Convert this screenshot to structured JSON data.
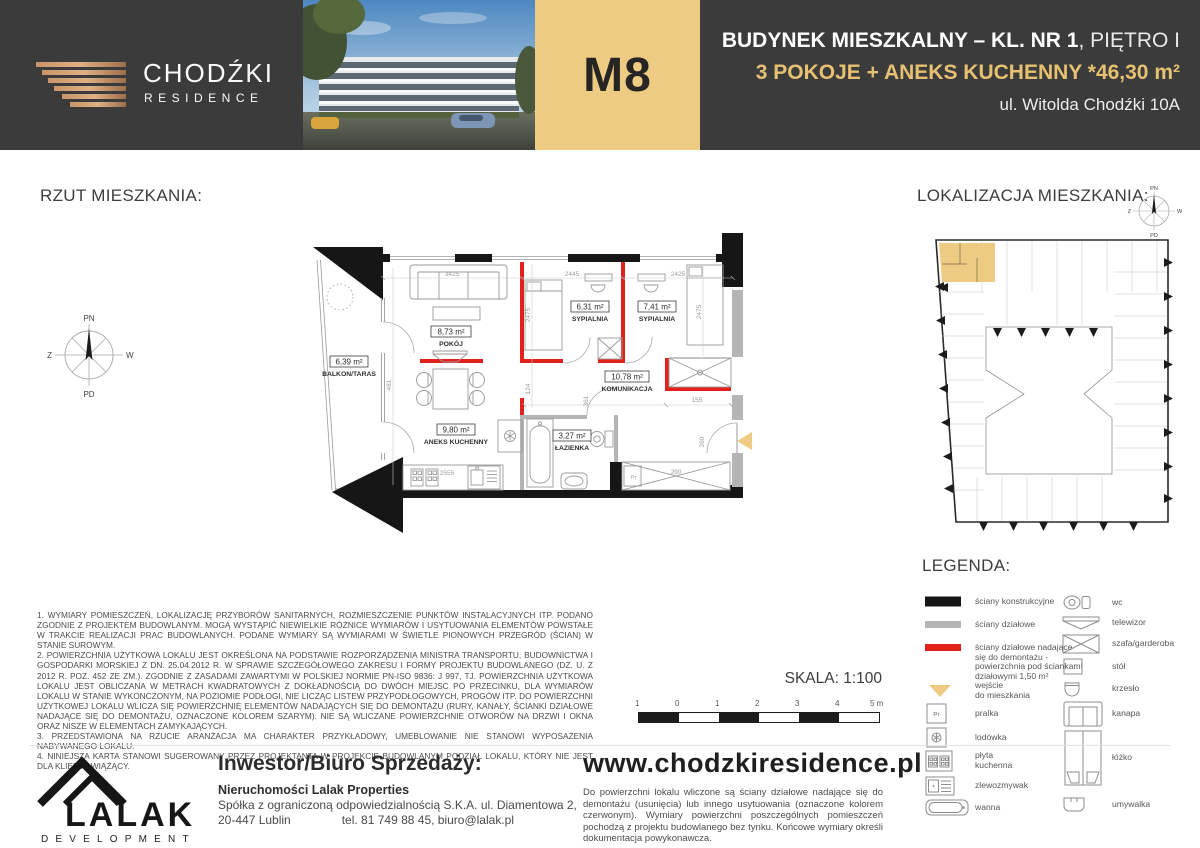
{
  "header": {
    "brand": {
      "name": "CHODŹKI",
      "sub": "RESIDENCE"
    },
    "unit_code": "M8",
    "line1_bold": "BUDYNEK MIESZKALNY – KL. NR 1",
    "line1_light": ", PIĘTRO I",
    "line2": "3 POKOJE + ANEKS KUCHENNY *46,30 m²",
    "line3": "ul. Witolda Chodźki 10A"
  },
  "plan": {
    "section_title": "RZUT MIESZKANIA:",
    "compass": {
      "n": "PN",
      "e": "W",
      "s": "PD",
      "w": "Z"
    },
    "rooms": [
      {
        "area": "6,39 m²",
        "name": "BALKON/TARAS"
      },
      {
        "area": "8,73 m²",
        "name": "POKÓJ"
      },
      {
        "area": "6,31 m²",
        "name": "SYPIALNIA"
      },
      {
        "area": "7,41 m²",
        "name": "SYPIALNIA"
      },
      {
        "area": "10,78 m²",
        "name": "KOMUNIKACJA"
      },
      {
        "area": "9,80 m²",
        "name": "ANEKS KUCHENNY"
      },
      {
        "area": "3,27 m²",
        "name": "ŁAZIENKA"
      }
    ],
    "dimensions": [
      "3425",
      "2445",
      "2425",
      "2475",
      "2475",
      "481",
      "2555",
      "124",
      "361",
      "155",
      "290",
      "260"
    ],
    "washer_label": "Pr",
    "scale_label": "SKALA: 1:100",
    "scale_ticks": [
      "1",
      "0",
      "1",
      "2",
      "3",
      "4",
      "5 m"
    ]
  },
  "location": {
    "section_title": "LOKALIZACJA MIESZKANIA:"
  },
  "legend": {
    "title": "LEGENDA:",
    "left": [
      {
        "icon": "wall-structural",
        "label": "ściany konstrukcyjne"
      },
      {
        "icon": "wall-partition",
        "label": "ściany działowe"
      },
      {
        "icon": "wall-demountable",
        "label": "ściany działowe nadające\nsię do demontażu -\npowierzchnia pod ściankami\ndziałowymi 1,50 m²"
      },
      {
        "icon": "entrance",
        "label": "wejście\ndo mieszkania"
      },
      {
        "icon": "washer",
        "label": "pralka"
      },
      {
        "icon": "fridge",
        "label": "lodówka"
      },
      {
        "icon": "hob",
        "label": "płyta\nkuchenna"
      },
      {
        "icon": "sink",
        "label": "zlewozmywak"
      },
      {
        "icon": "bathtub",
        "label": "wanna"
      }
    ],
    "right": [
      {
        "icon": "wc",
        "label": "wc"
      },
      {
        "icon": "tv",
        "label": "telewizor"
      },
      {
        "icon": "wardrobe",
        "label": "szafa/garderoba"
      },
      {
        "icon": "table",
        "label": "stół"
      },
      {
        "icon": "chair",
        "label": "krzesło"
      },
      {
        "icon": "sofa",
        "label": "kanapa"
      },
      {
        "icon": "bed",
        "label": "łóżko"
      },
      {
        "icon": "washbasin",
        "label": "umywalka"
      }
    ]
  },
  "notes": [
    "1. WYMIARY POMIESZCZEŃ, LOKALIZACJĘ PRZYBORÓW SANITARNYCH, ROZMIESZCZENIE PUNKTÓW INSTALACYJNYCH ITP. PODANO ZGODNIE Z PROJEKTEM BUDOWLANYM. MOGĄ WYSTĄPIĆ NIEWIELKIE RÓŻNICE WYMIARÓW I USYTUOWANIA ELEMENTÓW POWSTAŁE W TRAKCIE REALIZACJI PRAC BUDOWLANYCH. PODANE WYMIARY SĄ WYMIARAMI W ŚWIETLE PIONOWYCH PRZEGRÓD (ŚCIAN) W STANIE SUROWYM.",
    "2. POWIERZCHNIA UŻYTKOWA LOKALU JEST OKREŚLONA NA PODSTAWIE ROZPORZĄDZENIA MINISTRA TRANSPORTU, BUDOWNICTWA I GOSPODARKI MORSKIEJ Z DN. 25.04.2012 R. W SPRAWIE SZCZEGÓŁOWEGO ZAKRESU I FORMY PROJEKTU BUDOWLANEGO (DZ. U. Z 2012 R. POZ. 452 ZE ZM.). ZGODNIE Z ZASADAMI ZAWARTYMI W POLSKIEJ NORMIE PN-ISO 9836: J 997, TJ. POWIERZCHNIA UŻYTKOWA LOKALU JEST OBLICZANA W METRACH KWADRATOWYCH Z DOKŁADNOŚCIĄ DO DWÓCH MIEJSC PO PRZECINKU, DLA WYMIARÓW LOKALU W STANIE WYKONCZONYM, NA POZIOMIE PODŁOGI, NIE LICZĄC LISTEW PRZYPODŁOGOWYCH, PROGÓW ITP. DO POWIERZCHNI UŻYTKOWEJ LOKALU WLICZA SIĘ POWIERZCHNIĘ ELEMENTÓW NADAJĄCYCH SIĘ DO DEMONTAŻU (RURY, KANAŁY, ŚCIANKI DZIAŁOWE NADAJĄCE SIĘ DO DEMONTAŻU, OZNACZONE KOLOREM SZARYM). NIE SĄ WLICZANE POWIERZCHNIE OTWORÓW NA DRZWI I OKNA ORAZ NISZE W ELEMENTACH ZAMYKAJĄCYCH.",
    "3. PRZEDSTAWIONA NA RZUCIE ARANŻACJA MA CHARAKTER PRZYKŁADOWY, UMEBLOWANIE NIE STANOWI WYPOSAŻENIA NABYWANEGO LOKALU.",
    "4. NINIEJSZA KARTA STANOWI SUGEROWANY PRZEZ PROJEKTANTA W PROJEKCIE BUDOWLANYM PODZIAŁ LOKALU, KTÓRY NIE JEST DLA KLIENTA WIĄŻĄCY."
  ],
  "footer": {
    "logo_name": "LALAK",
    "logo_sub": "DEVELOPMENT",
    "investor_title": "Inwestor/Biuro Sprzedaży:",
    "company": "Nieruchomości Lalak Properties",
    "company_line2": "Spółka z ograniczoną odpowiedzialnością S.K.A. ul. Diamentowa 2,",
    "company_city": "20-447 Lublin",
    "company_contact": "tel. 81 749 88 45, biuro@lalak.pl",
    "website": "www.chodzkiresidence.pl",
    "disclaimer": "Do powierzchni lokalu wliczone są ściany działowe nadające się do demontażu (usunięcia) lub innego usytuowania (oznaczone kolorem czerwonym). Wymiary powierzchni poszczególnych pomieszczeń pochodzą   z projektu budowlanego bez tynku. Końcowe wymiary określi dokumentacja powykonawcza."
  },
  "colors": {
    "dark": "#3c3b3c",
    "gold": "#edcb82",
    "goldtext": "#e6c172",
    "red": "#e2201c",
    "graywall": "#b5b5b5",
    "blackwall": "#161616",
    "furn": "#9a9a9a",
    "dim": "#9a9a9a"
  }
}
